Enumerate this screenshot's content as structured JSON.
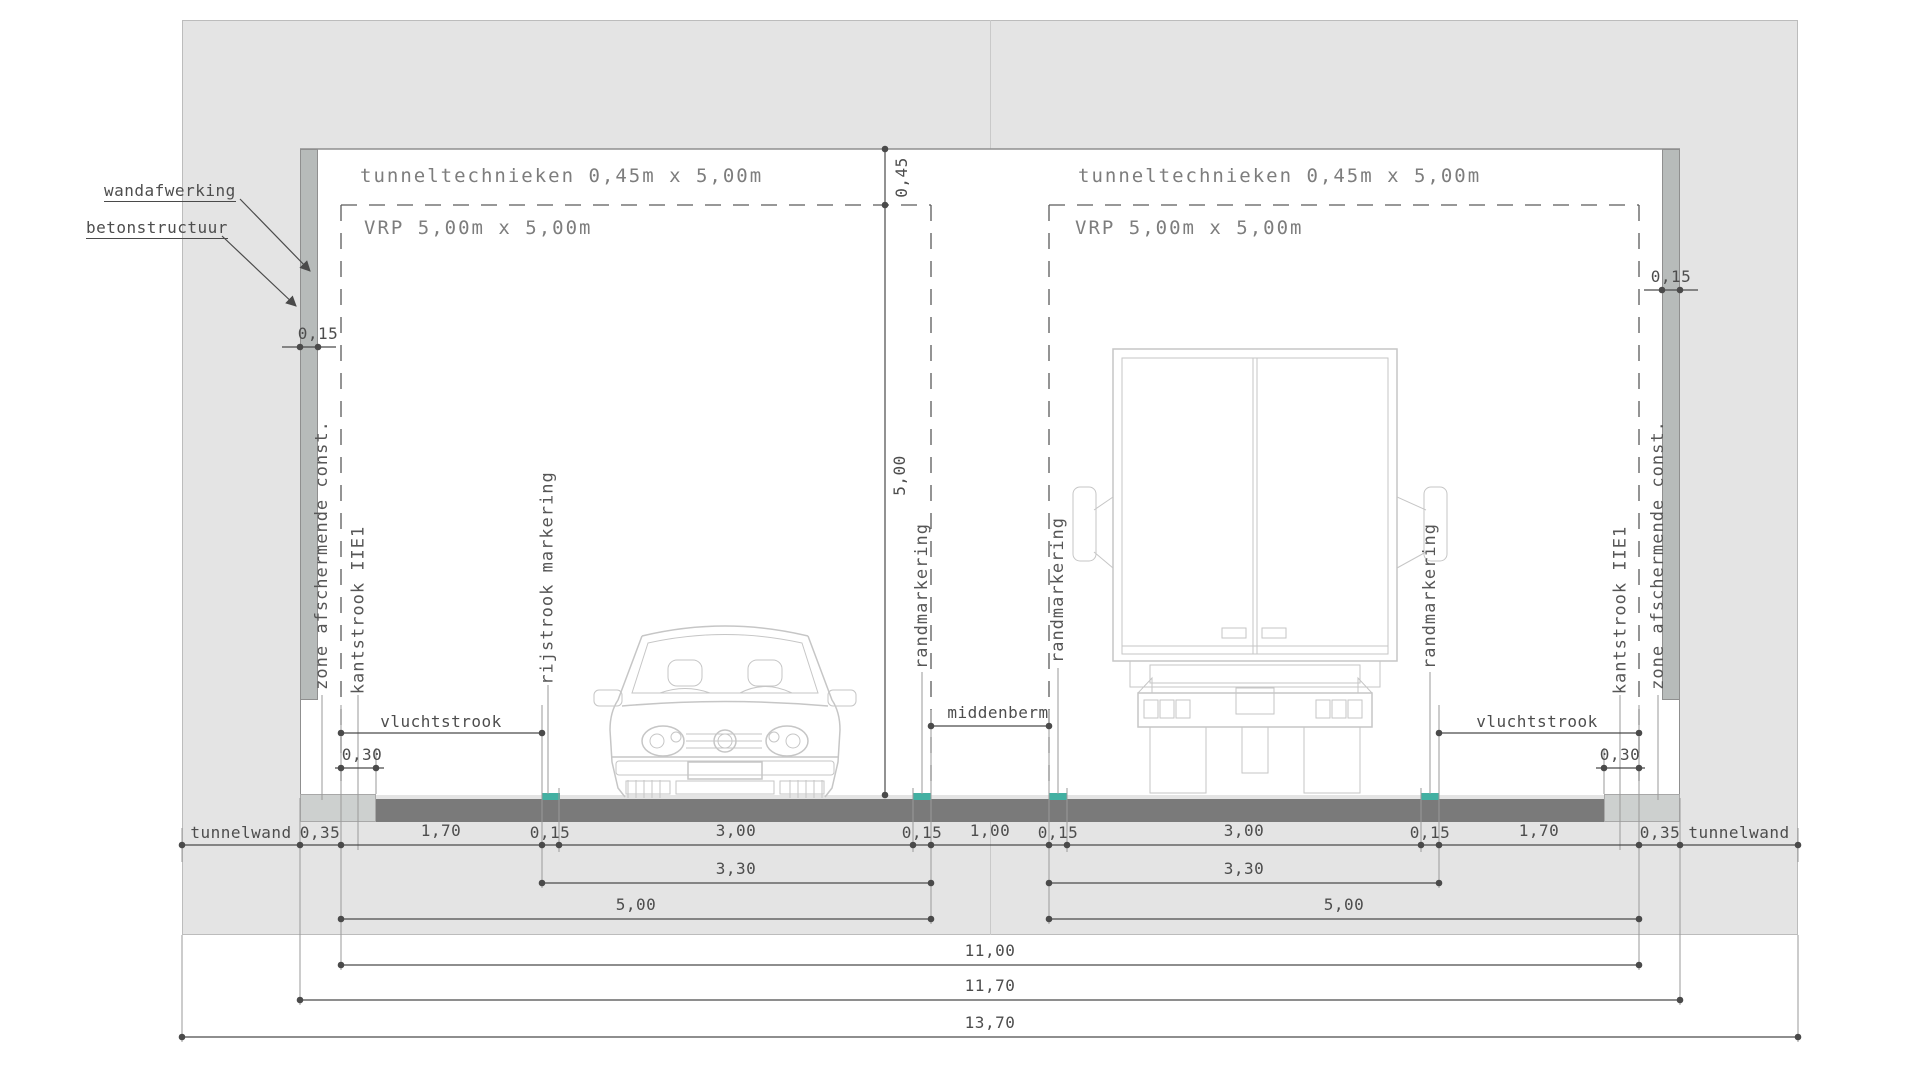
{
  "drawing": {
    "type": "tunnel cross-section technical drawing",
    "leaders": {
      "wandafwerking": "wandafwerking",
      "betonstructuur": "betonstructuur"
    },
    "zones": {
      "tunneltechnieken": "tunneltechnieken 0,45m x 5,00m",
      "vrp": "VRP 5,00m x 5,00m"
    },
    "road_labels": {
      "zone_afschermende": "zone afschermende const.",
      "kantstrook": "kantstrook IIE1",
      "rijstrook_markering": "rijstrook markering",
      "randmarkering": "randmarkering",
      "vluchtstrook": "vluchtstrook",
      "middenberm": "middenberm",
      "tunnelwand": "tunnelwand"
    },
    "dims": {
      "d045": "0,45",
      "d500_height": "5,00",
      "d015": "0,15",
      "d030": "0,30",
      "row1": [
        "0,35",
        "1,70",
        "0,15",
        "3,00",
        "0,15",
        "1,00",
        "0,15",
        "3,00",
        "0,15",
        "1,70",
        "0,35"
      ],
      "d330": "3,30",
      "d500": "5,00",
      "d1100": "11,00",
      "d1170": "11,70",
      "d1370": "13,70"
    },
    "colors": {
      "concrete": "#e4e4e4",
      "interior": "#ffffff",
      "wallfinish": "#b7bbba",
      "road": "#7a7a7a",
      "curb": "#cdd0cf",
      "marking": "#43b0a2",
      "line": "#4a4a4a",
      "lightline": "#9a9a9a",
      "text": "#4d4d4d",
      "vehicle": "#c6c6c6"
    }
  }
}
